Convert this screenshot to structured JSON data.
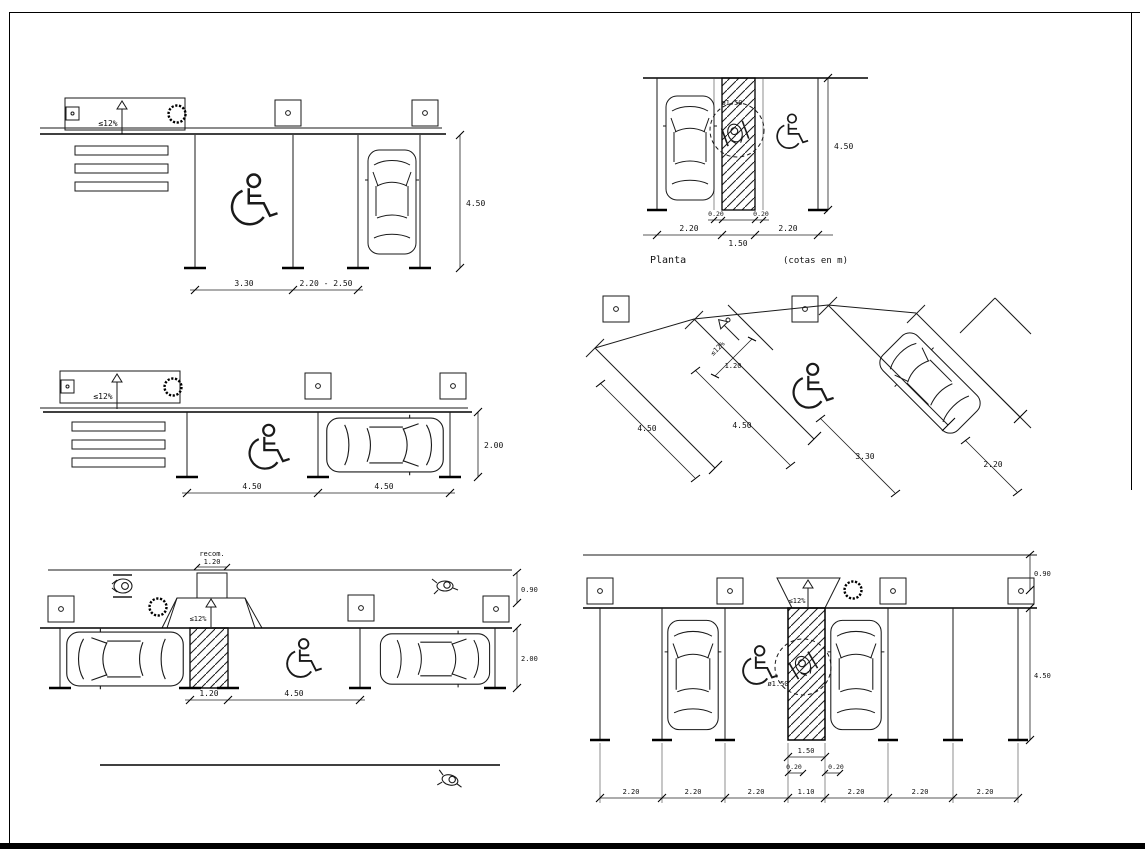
{
  "sheet": {
    "background": "#ffffff",
    "line_color": "#000000"
  },
  "d1": {
    "slope": "≤12%",
    "stall_width": "3.30",
    "adjacent_stall": "2.20 - 2.50",
    "depth": "4.50"
  },
  "d2": {
    "slope": "≤12%",
    "stall_a": "4.50",
    "stall_b": "4.50",
    "depth": "2.00"
  },
  "d3": {
    "walk_note": "recom.",
    "walk_width": "1.20",
    "slope": "≤12%",
    "ramp_width": "1.20",
    "stall_length": "4.50",
    "sidewalk": "0.90",
    "depth": "2.00"
  },
  "d4": {
    "title": "Planta",
    "units": "(cotas en m)",
    "turning": "ø1.50",
    "stall_left": "2.20",
    "margin_left": "0.20",
    "aisle": "1.50",
    "margin_right": "0.20",
    "stall_right": "2.20",
    "depth": "4.50"
  },
  "d5": {
    "slope": "≤12%",
    "ramp_width": "1.20",
    "stall_a": "4.50",
    "stall_b": "4.50",
    "car_stall": "3.30",
    "stall_width": "2.20"
  },
  "d6": {
    "slope": "≤12%",
    "turning": "ø1.50",
    "sidewalk": "0.90",
    "depth": "4.50",
    "aisle": "1.50",
    "margin_left": "0.20",
    "margin_right": "0.20",
    "row": [
      "2.20",
      "2.20",
      "2.20",
      "1.10",
      "2.20",
      "2.20",
      "2.20"
    ]
  }
}
